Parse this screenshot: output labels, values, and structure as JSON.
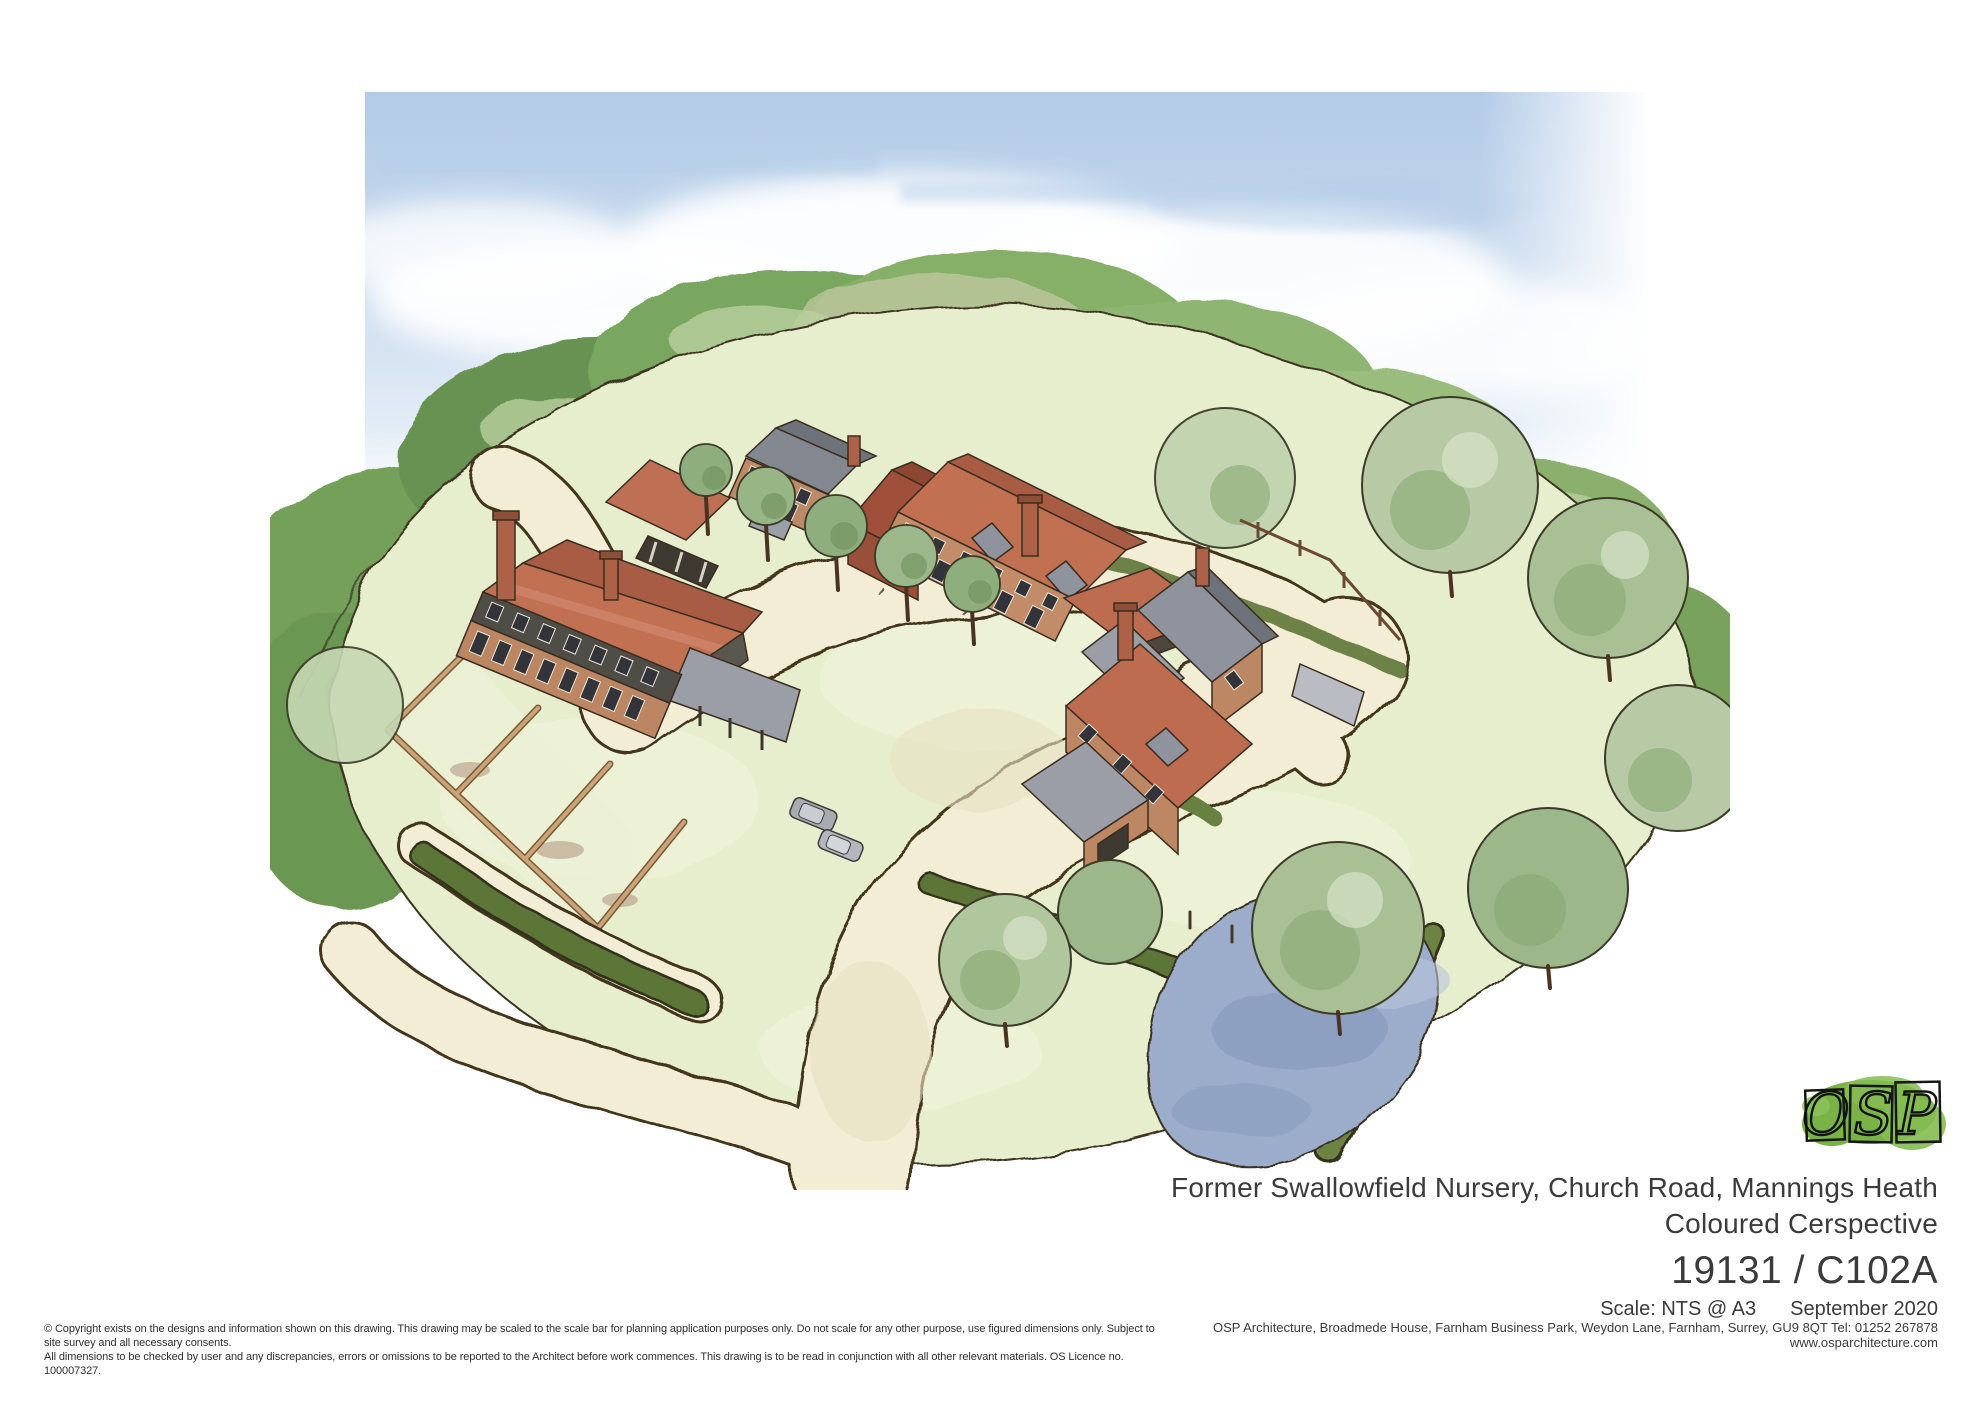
{
  "sheet": {
    "title_block": {
      "project_title": "Former Swallowfield Nursery, Church Road, Mannings Heath",
      "drawing_title": "Coloured Cerspective",
      "drawing_number": "19131 / C102A",
      "scale_label": "Scale: NTS @ A3",
      "date": "September 2020"
    },
    "logo": {
      "text": "OSP"
    },
    "notes": {
      "copyright_line_1": "© Copyright exists on the designs and information shown on this drawing. This drawing may be scaled to the scale bar for planning application purposes only. Do not scale for any other purpose, use figured dimensions only. Subject to site survey and all necessary consents.",
      "copyright_line_2": "All dimensions to be checked by user and any discrepancies, errors or omissions to be reported to the Architect before work commences. This drawing is to be read in conjunction with all other relevant materials. OS Licence no. 100007327."
    },
    "firm": {
      "address": "OSP Architecture, Broadmede House, Farnham Business Park, Weydon Lane, Farnham, Surrey, GU9 8QT Tel: 01252 267878",
      "website": "www.osparchitecture.com"
    },
    "colors": {
      "logo_green": "#79b345",
      "roof_terracotta": "#bf7052",
      "roof_slate": "#8f939d",
      "brick": "#c08a66",
      "timber_dark": "#4e4e47",
      "foliage_dark": "#5d8146",
      "foliage_light": "#aac493",
      "lawn": "#e6eecd",
      "road": "#f2edd4",
      "pond": "#9cadcb",
      "sky": "#bfd4ea",
      "text": "#3b3b3b"
    }
  }
}
